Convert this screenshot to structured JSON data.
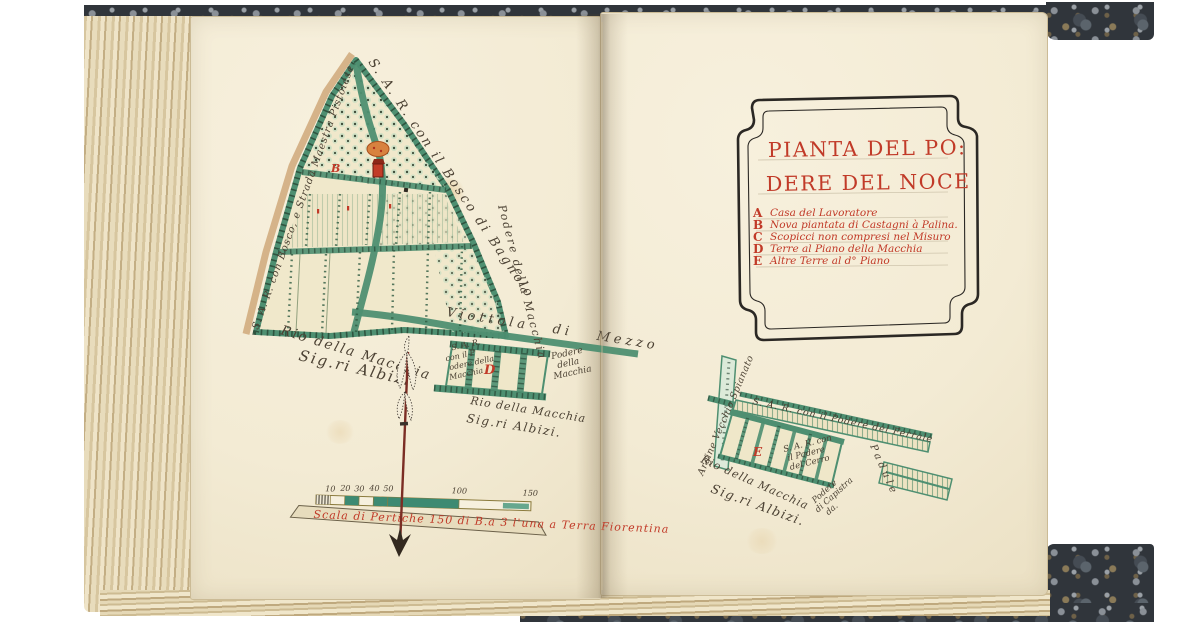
{
  "page_title": "Pianta del Podere del Noce",
  "ink_colors": {
    "handwriting": "#4c4234",
    "red": "#c13a28",
    "green": "#4e8f71",
    "teal_bar": "#3d8a72",
    "road_tan": "#c9a87c"
  },
  "left_map": {
    "edge_top": "S. A. R. con il Bosco di Bagnolo",
    "edge_left": "S. A. R. con Bosco, e Strada Maestra Pistoiese",
    "edge_right": "Podere della Macchia",
    "road_mid": "Viottola di Mezzo",
    "rio_line1": "Rio della Macchia",
    "rio_line2": "Sig.ri Albizi.",
    "marker_b": "B",
    "parcel_d": {
      "letter": "D",
      "left_lines": [
        "S. A. R.",
        "con il P",
        "odere della",
        "Macchia"
      ],
      "right_lines": [
        "Podere",
        "della",
        "Macchia"
      ],
      "below_line1": "Rio della Macchia",
      "below_line2": "Sig.ri Albizi."
    },
    "scale": {
      "ticks": [
        "10",
        "20",
        "30",
        "40",
        "50",
        "100",
        "150"
      ],
      "caption": "Scala di Pertiche 150 di B.a 3 l'una a Terra Fiorentina"
    }
  },
  "cartouche": {
    "title_line1": "PIANTA DEL PO:",
    "title_line2": "DERE DEL NOCE",
    "legend": [
      {
        "key": "A",
        "text": "Casa del Lavoratore"
      },
      {
        "key": "B",
        "text": "Nova piantata di Castagni à Palina."
      },
      {
        "key": "C",
        "text": "Scopicci non compresi nel Misuro"
      },
      {
        "key": "D",
        "text": "Terre al Piano della Macchia"
      },
      {
        "key": "E",
        "text": "Altre Terre al d° Piano"
      }
    ]
  },
  "right_map": {
    "letter_e": "E",
    "argine": "Argine Vecchio Spianato",
    "edge_top": "S. A. R. con il Podere del Ferrale",
    "cerro_lines": [
      "S. A. R. con",
      "il Podere",
      "del Cerro"
    ],
    "rio_line1": "Rio della Macchia",
    "rio_line2": "Sig.ri Albizi.",
    "capistra_lines": [
      "Podere",
      "di Capistra",
      "da."
    ],
    "padule": "Padule"
  }
}
